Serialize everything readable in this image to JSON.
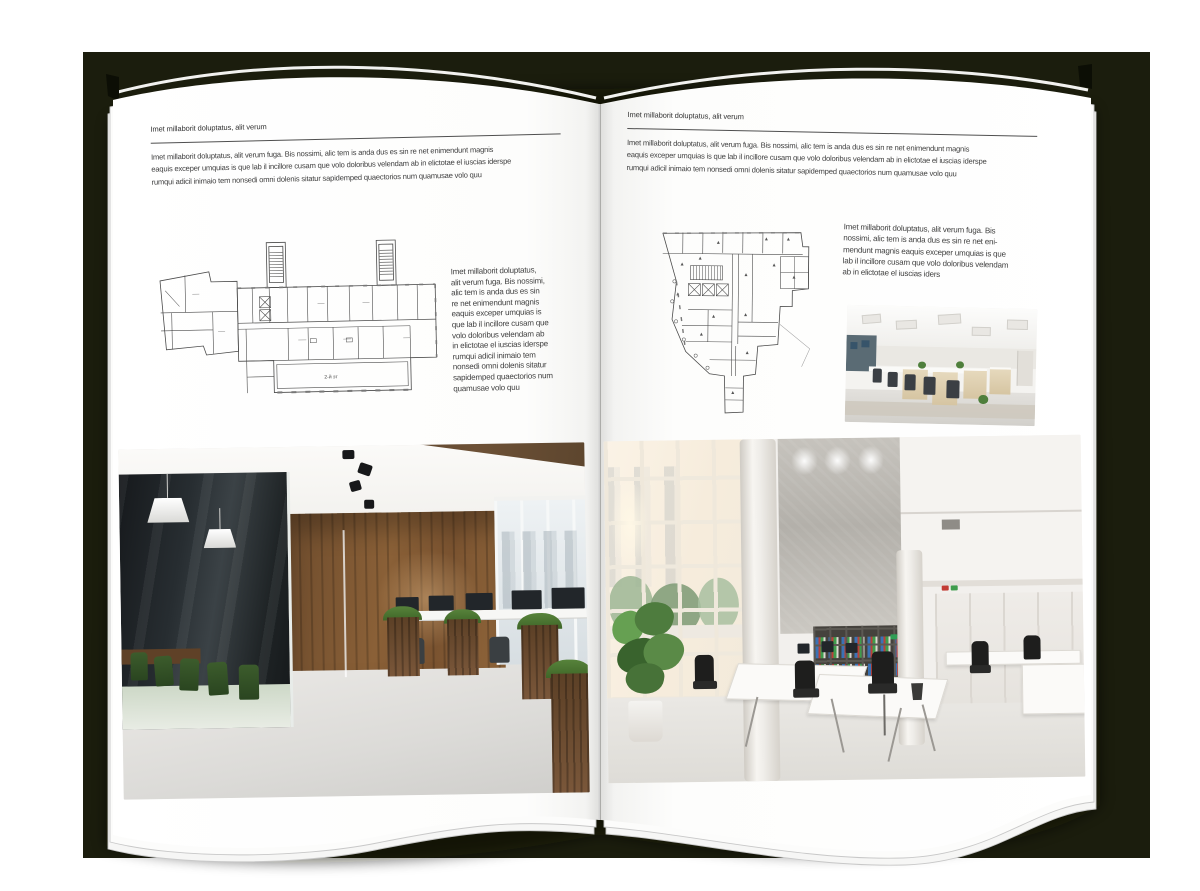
{
  "palette": {
    "backdrop": "#1b1d0d",
    "page": "#ffffff",
    "text": "#3f3f3f",
    "rule": "#4f4f4f",
    "wood_accent": "#7b5734",
    "binder_blue": "#3a72b5",
    "binder_red": "#b94038",
    "binder_green": "#3f9c4c"
  },
  "left_page": {
    "header": "Imet millaborit doluptatus, alit verum",
    "intro_lines": [
      "Imet millaborit doluptatus, alit verum fuga. Bis nossimi, alic tem is anda dus es sin re net enimendunt magnis",
      "eaquis exceper umquias is que lab il incillore cusam que volo doloribus velendam ab in elictotae el iuscias iderspe",
      "rumqui adicil inimaio tem nonsedi omni dolenis sitatur sapidemped quaectorios num quamusae volo quu"
    ],
    "floor_plan_label": "2-й эт",
    "side_text_lines": [
      "Imet millaborit doluptatus,",
      "alit verum fuga. Bis nossimi,",
      "alic tem is anda dus es sin",
      "re net enimendunt magnis",
      "eaquis exceper umquias is",
      "que lab il incillore cusam que",
      "volo doloribus velendam ab",
      "in elictotae el iuscias iderspe",
      "rumqui adicil inimaio tem",
      "nonsedi omni dolenis sitatur",
      "sapidemped quaectorios num",
      "quamusae volo quu"
    ]
  },
  "right_page": {
    "header": "Imet millaborit doluptatus, alit verum",
    "intro_lines": [
      "Imet millaborit doluptatus, alit verum fuga. Bis nossimi, alic tem is anda dus es sin re net enimendunt magnis",
      "eaquis exceper umquias is que lab il incillore cusam que volo doloribus velendam ab in elictotae el iuscias iderspe",
      "rumqui adicil inimaio tem nonsedi omni dolenis sitatur sapidemped quaectorios num quamusae volo quu"
    ],
    "side_text_lines": [
      "Imet millaborit doluptatus, alit verum fuga. Bis",
      "nossimi, alic tem is anda dus es sin re net eni-",
      "mendunt magnis eaquis exceper umquias is que",
      "lab il incillore cusam que volo doloribus velendam",
      "ab in elictotae el iuscias iders"
    ]
  }
}
